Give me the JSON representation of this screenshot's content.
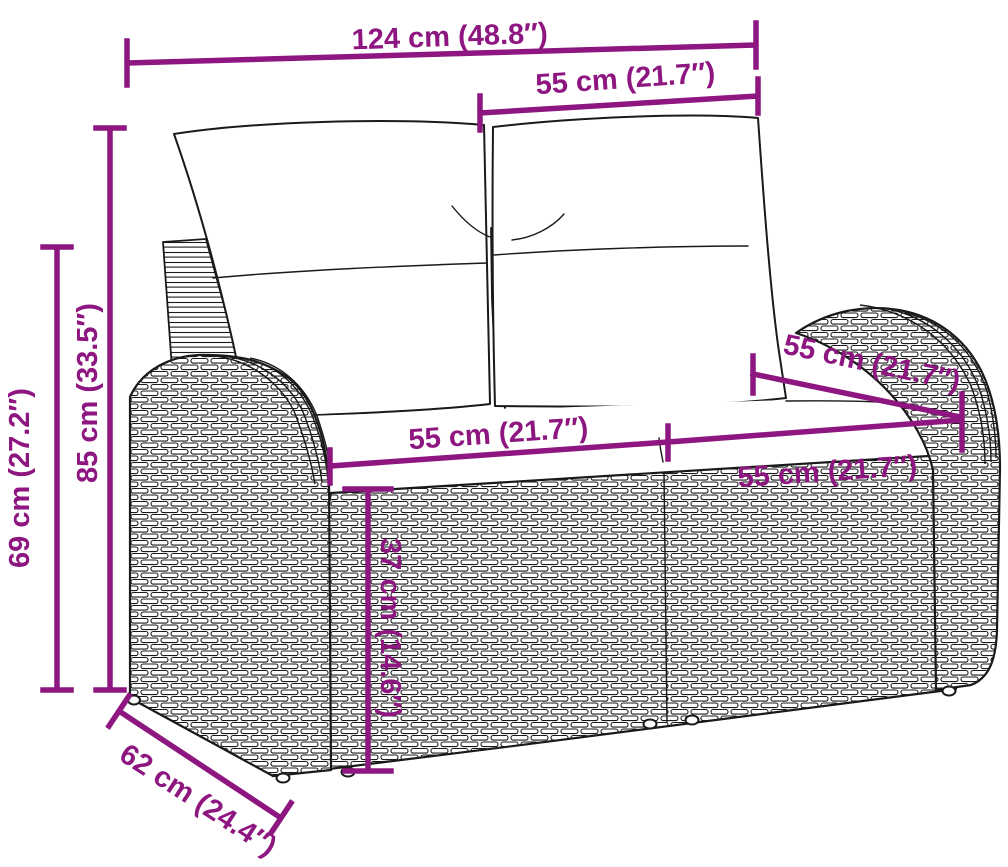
{
  "diagram": {
    "type": "product-dimension-diagram",
    "subject": "poly-rattan 2-seater garden sofa with back and seat cushions",
    "colors": {
      "annotation": "#8E1680",
      "line_art": "#1a1a1a",
      "background": "#ffffff"
    },
    "dimensions": [
      {
        "id": "overall-width",
        "label": "124 cm (48.8″)"
      },
      {
        "id": "backrest-width",
        "label": "55 cm (21.7″)"
      },
      {
        "id": "overall-height",
        "label": "85 cm (33.5″)"
      },
      {
        "id": "armrest-height",
        "label": "69 cm (27.2″)"
      },
      {
        "id": "seat-width-left",
        "label": "55 cm (21.7″)"
      },
      {
        "id": "seat-width-right",
        "label": "55 cm (21.7″)"
      },
      {
        "id": "seat-depth",
        "label": "55 cm (21.7″)"
      },
      {
        "id": "seat-height",
        "label": "37 cm (14.6″)"
      },
      {
        "id": "overall-depth",
        "label": "62 cm (24.4″)"
      }
    ]
  }
}
